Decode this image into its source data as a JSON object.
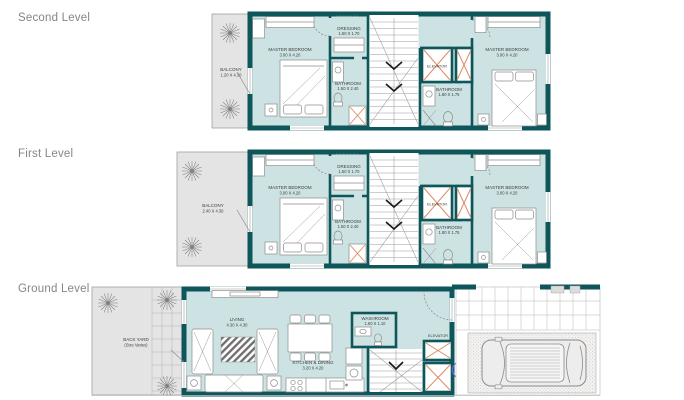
{
  "document": {
    "background": "#ffffff",
    "type": "floor-plan-sheet"
  },
  "palette": {
    "wall": "#0e565a",
    "room_fill": "#cde3e3",
    "outdoor_fill": "#e4e4e4",
    "outline_gray": "#9b9b9b",
    "furniture_line": "#8c8c8c",
    "elevator_cross": "#e08a65",
    "stair_arrow": "#1c1c1c",
    "annotation_blue": "#6a6ae0",
    "level_title_color": "#858585"
  },
  "levels": {
    "second": {
      "title": "Second Level",
      "balcony": {
        "name": "BALCONY",
        "dims": "1.20 X 4.30"
      }
    },
    "first": {
      "title": "First Level",
      "balcony": {
        "name": "BALCONY",
        "dims": "2.40 X 4.30"
      }
    },
    "ground": {
      "title": "Ground Level",
      "rooms": {
        "back_yard": {
          "name": "BACK YARD",
          "dims": "(Size Varies)"
        },
        "living": {
          "name": "LIVING",
          "dims": "4.30 X 4.30"
        },
        "kitchen_dining": {
          "name": "KITCHEN & DINING",
          "dims": "3.20 X 4.20"
        },
        "washroom": {
          "name": "WASHROOM",
          "dims": "1.60 X 1.10"
        },
        "elevator": {
          "name": "ELEVATOR"
        }
      }
    }
  },
  "upper_unit_rooms": {
    "master_bedroom_left": {
      "name": "MASTER BEDROOM",
      "dims": "3.00 X 4.20"
    },
    "dressing": {
      "name": "DRESSING",
      "dims": "1.50 X 1.70"
    },
    "bathroom_left": {
      "name": "BATHROOM",
      "dims": "1.50 X 2.40"
    },
    "elevator": {
      "name": "ELEVATOR"
    },
    "bathroom_right": {
      "name": "BATHROOM",
      "dims": "1.80 X 1.75"
    },
    "master_bedroom_right": {
      "name": "MASTER BEDROOM",
      "dims": "3.00 X 4.20"
    }
  }
}
